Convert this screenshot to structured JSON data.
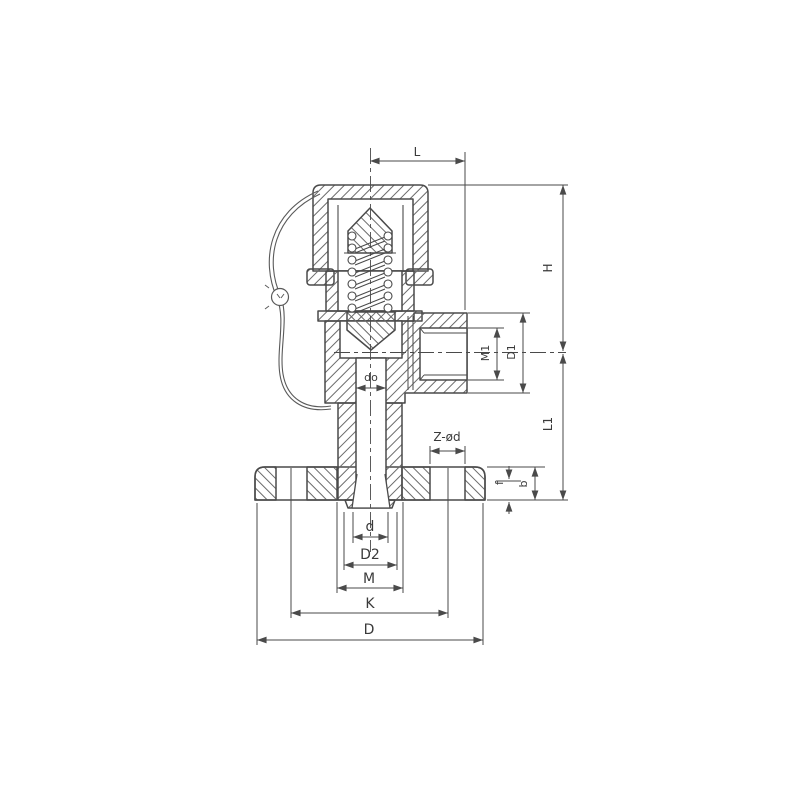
{
  "page": {
    "background": "#ffffff"
  },
  "drawing": {
    "type": "technical-drawing",
    "subject": "spring-loaded safety relief valve cross-section, flanged inlet, threaded side outlet, lead seal wire",
    "colors": {
      "line": "#4a4a4a",
      "hatch": "#6b6b6b",
      "text": "#3a3a3a",
      "background": "#ffffff"
    },
    "dimensions": {
      "L": "L",
      "H": "H",
      "L1": "L1",
      "M1": "M1",
      "D1": "D1",
      "Z_od": "Z-ød",
      "f": "f",
      "b": "b",
      "d_o": "do",
      "d": "d",
      "D2": "D2",
      "M": "M",
      "K": "K",
      "D": "D"
    }
  }
}
